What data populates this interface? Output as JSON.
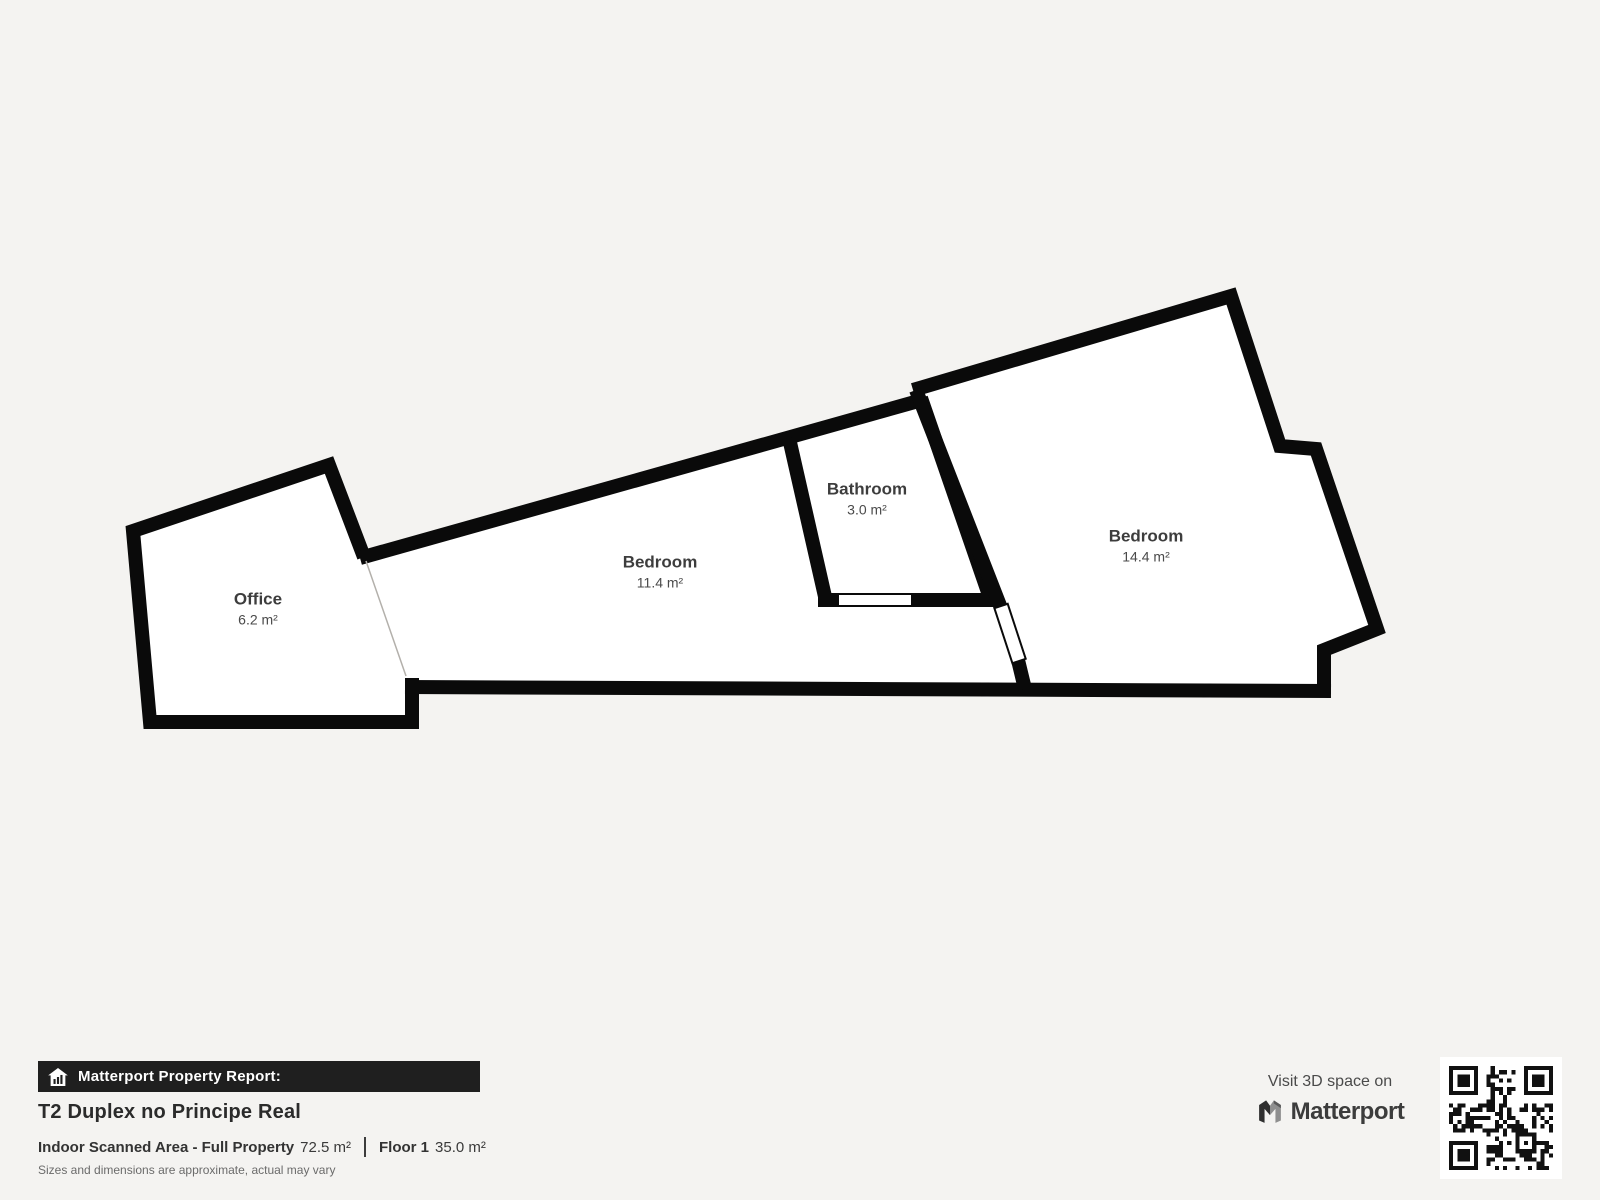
{
  "colors": {
    "background": "#f4f3f1",
    "wall": "#0a0a0a",
    "room_fill": "#ffffff",
    "banner_bg": "#1f1f1f",
    "open_boundary_line": "#b3b0ab"
  },
  "floorplan": {
    "rooms": [
      {
        "name": "Office",
        "area": "6.2 m²"
      },
      {
        "name": "Bedroom",
        "area": "11.4 m²"
      },
      {
        "name": "Bathroom",
        "area": "3.0 m²"
      },
      {
        "name": "Bedroom",
        "area": "14.4 m²"
      }
    ]
  },
  "report": {
    "banner_label": "Matterport Property Report:",
    "title": "T2 Duplex no Principe Real",
    "scanned_label": "Indoor Scanned Area - Full Property",
    "scanned_value": "72.5 m²",
    "floor_label": "Floor 1",
    "floor_value": "35.0 m²",
    "disclaimer": "Sizes and dimensions are approximate, actual may vary"
  },
  "branding": {
    "visit_text": "Visit 3D space on",
    "brand_name": "Matterport",
    "icons": [
      "house-report-icon",
      "matterport-m-icon",
      "qr-code"
    ]
  }
}
